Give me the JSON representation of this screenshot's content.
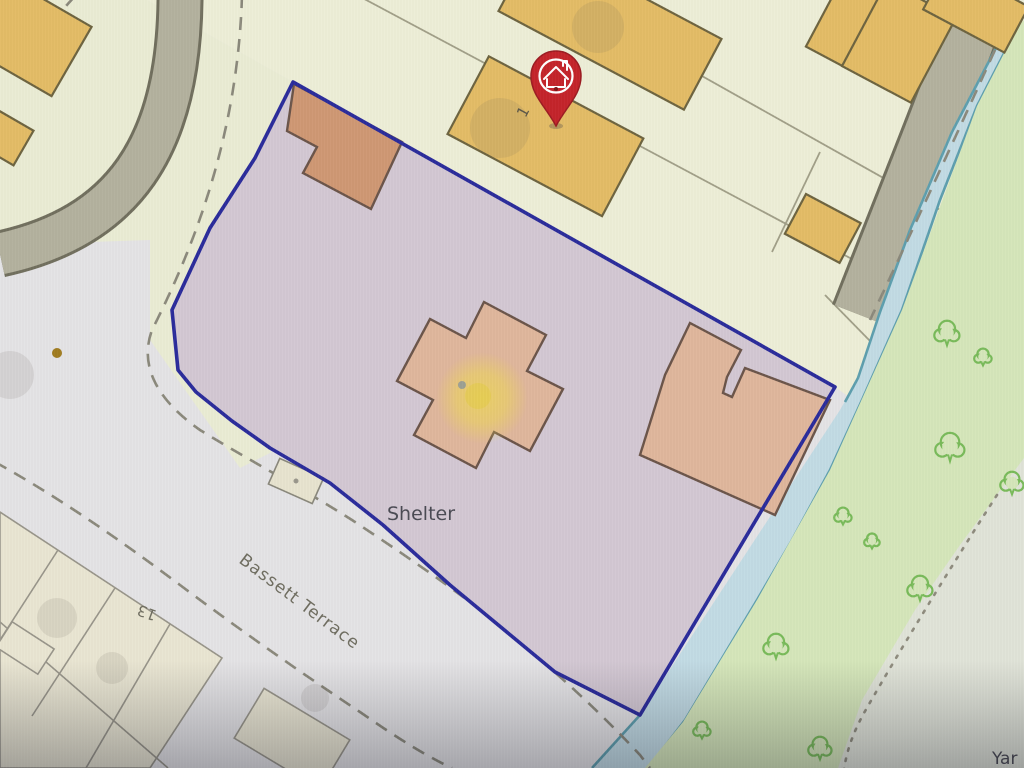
{
  "map": {
    "labels": {
      "shelter": "Shelter",
      "street_name": "Bassett Terrace",
      "plot_number_1": "1",
      "house_number_13": "13",
      "corner_label": "Yar"
    },
    "icons": {
      "pin": "map-pin-house-icon",
      "tree": "deciduous-tree-icon"
    },
    "colors": {
      "plot_boundary": "#2b2c9b",
      "plot_fill": "#d3c8d3",
      "pin_red": "#c4242b",
      "highlight_yellow": "#eed952",
      "water_fill": "#c2dbe4",
      "water_edge": "#5e9fae",
      "greenspace": "#d5e6ba",
      "tree_outline": "#79bb5a",
      "building_yellow": "#e3bc66",
      "building_tan": "#dfb69c",
      "building_tan_dark": "#cf9874",
      "road": "#b3b19e",
      "parcel_cream": "#edeed7",
      "background_grey": "#e4e3e5"
    },
    "features": {
      "trees": [
        [
          947,
          333,
          13
        ],
        [
          983,
          357,
          9
        ],
        [
          950,
          447,
          15
        ],
        [
          1012,
          483,
          12
        ],
        [
          843,
          516,
          9
        ],
        [
          872,
          541,
          8
        ],
        [
          920,
          588,
          13
        ],
        [
          776,
          646,
          13
        ],
        [
          702,
          730,
          9
        ],
        [
          820,
          748,
          12
        ]
      ],
      "smudges": [
        [
          500,
          128,
          30
        ],
        [
          598,
          27,
          26
        ],
        [
          10,
          375,
          24
        ],
        [
          57,
          618,
          20
        ],
        [
          112,
          668,
          16
        ],
        [
          315,
          698,
          14
        ]
      ]
    }
  }
}
